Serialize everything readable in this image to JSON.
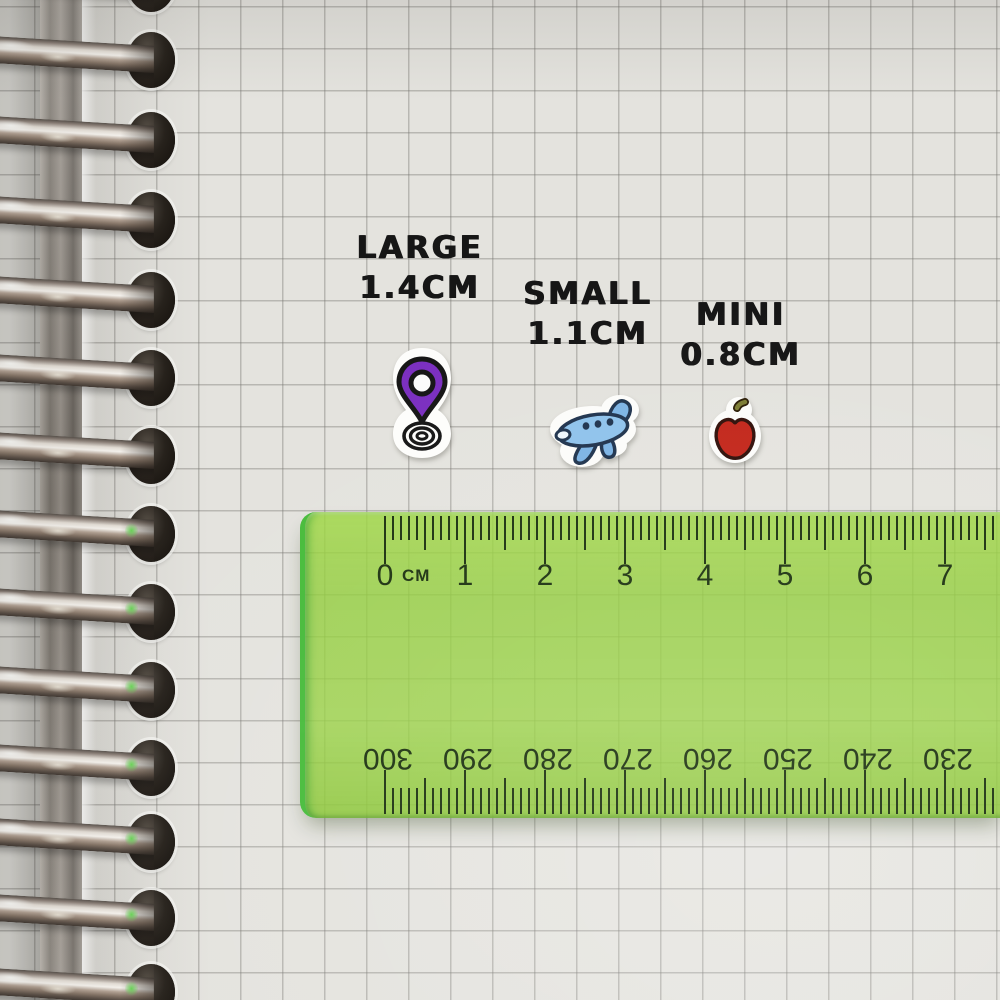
{
  "size_labels": [
    {
      "name": "LARGE",
      "size": "1.4CM"
    },
    {
      "name": "SMALL",
      "size": "1.1CM"
    },
    {
      "name": "MINI",
      "size": "0.8CM"
    }
  ],
  "stickers": [
    {
      "name": "location-pin",
      "size_label": "LARGE",
      "main_color": "#7b2fc0"
    },
    {
      "name": "airplane",
      "size_label": "SMALL",
      "main_color": "#8fc3ec"
    },
    {
      "name": "apple",
      "size_label": "MINI",
      "main_color": "#c3271b"
    }
  ],
  "ruler": {
    "unit_label": "CM",
    "top_scale_numbers": [
      "0",
      "1",
      "2",
      "3",
      "4",
      "5",
      "6",
      "7"
    ],
    "bottom_scale_numbers": [
      "300",
      "290",
      "280",
      "270",
      "260",
      "250",
      "240",
      "230"
    ],
    "body_color": "#8cc63e",
    "marking_color": "#1e3312"
  },
  "notebook": {
    "paper_color": "#e4e3de",
    "grid_color": "#b3b2ae",
    "binding": "silver-spiral-rings"
  }
}
